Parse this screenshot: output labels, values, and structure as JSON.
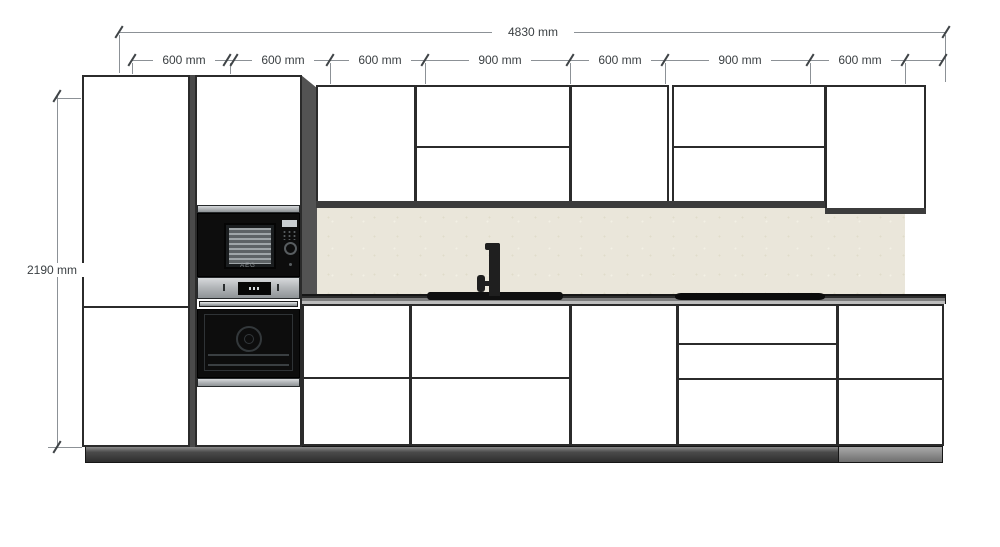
{
  "drawing": {
    "type": "kitchen-elevation",
    "overall_dimension": {
      "label": "4830 mm"
    },
    "height_dimension": {
      "label": "2190 mm"
    },
    "segments": [
      {
        "label": "600 mm"
      },
      {
        "label": "600 mm"
      },
      {
        "label": "600 mm"
      },
      {
        "label": "900 mm"
      },
      {
        "label": "600 mm"
      },
      {
        "label": "900 mm"
      },
      {
        "label": "600 mm"
      }
    ],
    "appliances": {
      "microwave_brand": "AEG"
    },
    "colors": {
      "outline": "#2b2b2b",
      "dim-line": "#8c9196",
      "dim-text": "#3b4043",
      "cabinet": "#ffffff",
      "backsplash": "#eae6da",
      "side-panel": "#535353",
      "stainless": "#b4b7ba",
      "appliance": "#0d0d0d",
      "plinth": "#3a3a3a"
    }
  }
}
